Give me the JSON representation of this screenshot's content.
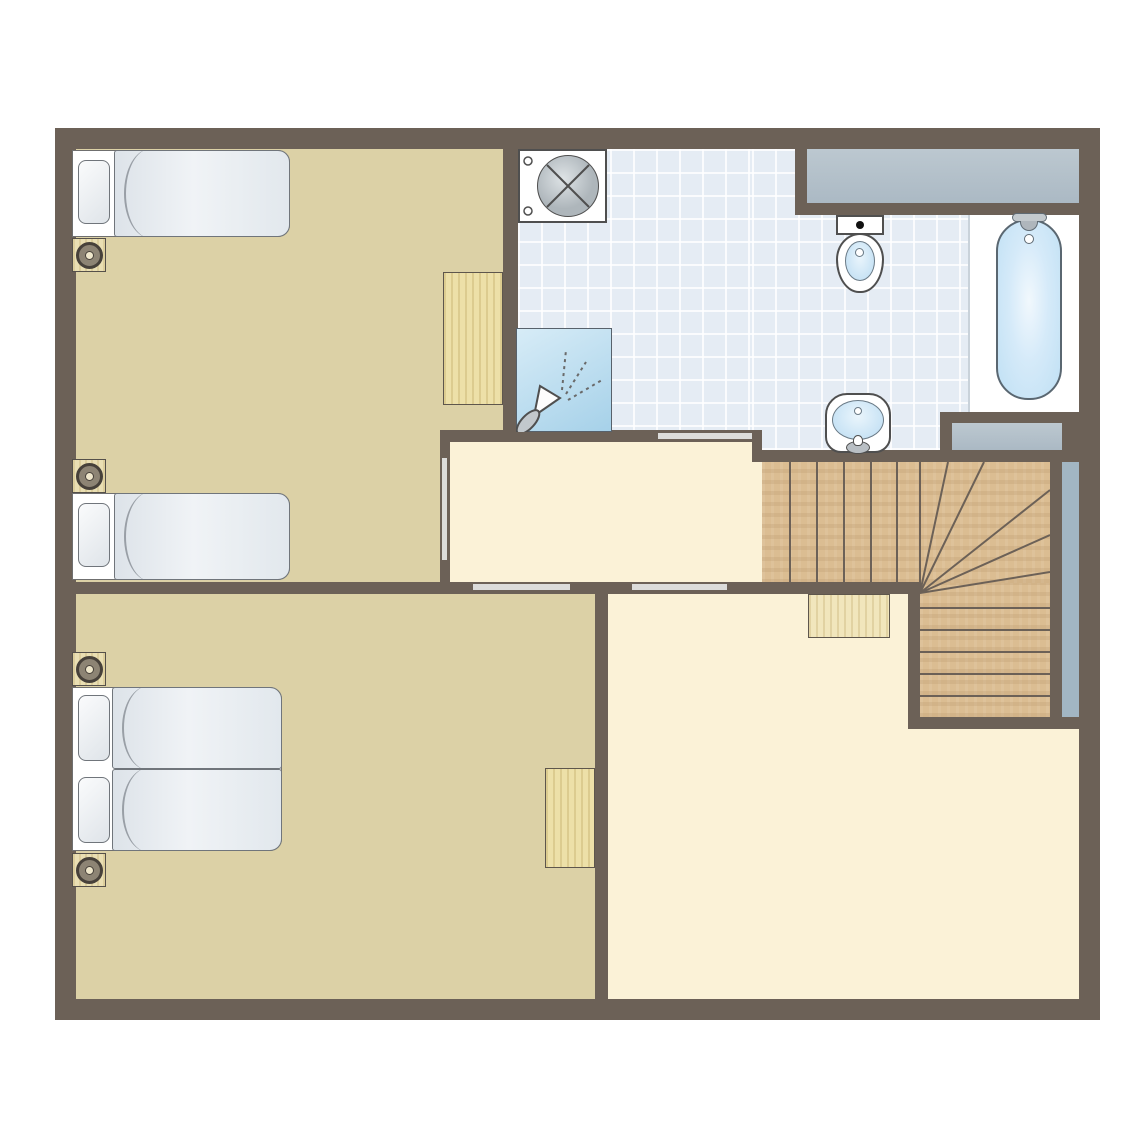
{
  "plan": {
    "type": "apartment-upper-floor-plan",
    "rooms": [
      {
        "id": "bedroom-top-left",
        "floor": "tan-carpet",
        "fixtures": [
          "single-bed",
          "single-bed",
          "nightstand-with-lamp",
          "nightstand-with-lamp",
          "desk"
        ]
      },
      {
        "id": "bathroom-top-right",
        "floor": "blue-tile",
        "fixtures": [
          "washing-machine",
          "shower",
          "counter",
          "toilet",
          "washbasin",
          "bathtub"
        ]
      },
      {
        "id": "hallway-landing",
        "floor": "cream",
        "fixtures": [
          "door-to-bedroom-top-left",
          "door-to-bathroom",
          "door-to-bedroom-bottom-left",
          "door-to-living-room"
        ]
      },
      {
        "id": "stairwell",
        "floor": "wood",
        "fixtures": [
          "straight-stair-run",
          "winder-steps",
          "lower-stair-run",
          "banister-strip"
        ]
      },
      {
        "id": "bedroom-bottom-left",
        "floor": "tan-carpet",
        "fixtures": [
          "double-bed",
          "nightstand-with-lamp",
          "nightstand-with-lamp",
          "desk"
        ]
      },
      {
        "id": "living-room-bottom-right",
        "floor": "cream",
        "fixtures": [
          "under-stair-cabinet"
        ]
      }
    ],
    "door_openings": 4,
    "stair_counts": {
      "straight_treads": 6,
      "winder_treads": 5,
      "lower_treads": 6
    }
  },
  "palette": {
    "page_bg": "#FFFFFF",
    "wall": "#6C6157",
    "bedroom_floor": "#DCD1A6",
    "hall_floor": "#FBF2D7",
    "tile_floor": "#E5ECF4",
    "tile_grid": "#FFFFFF",
    "wood_stairs": "#DBBD92",
    "wood_furniture": "#EDE0A8",
    "wood_cabinet": "#F1E6BC",
    "counter_gray": "#ABB9C4",
    "banister_blue": "#A2B6C3",
    "water_blue": "#BBDCF2",
    "fixture_outline": "#4F4F4F",
    "door_line": "#DCDCDA",
    "bed_white": "#FFFFFF"
  }
}
